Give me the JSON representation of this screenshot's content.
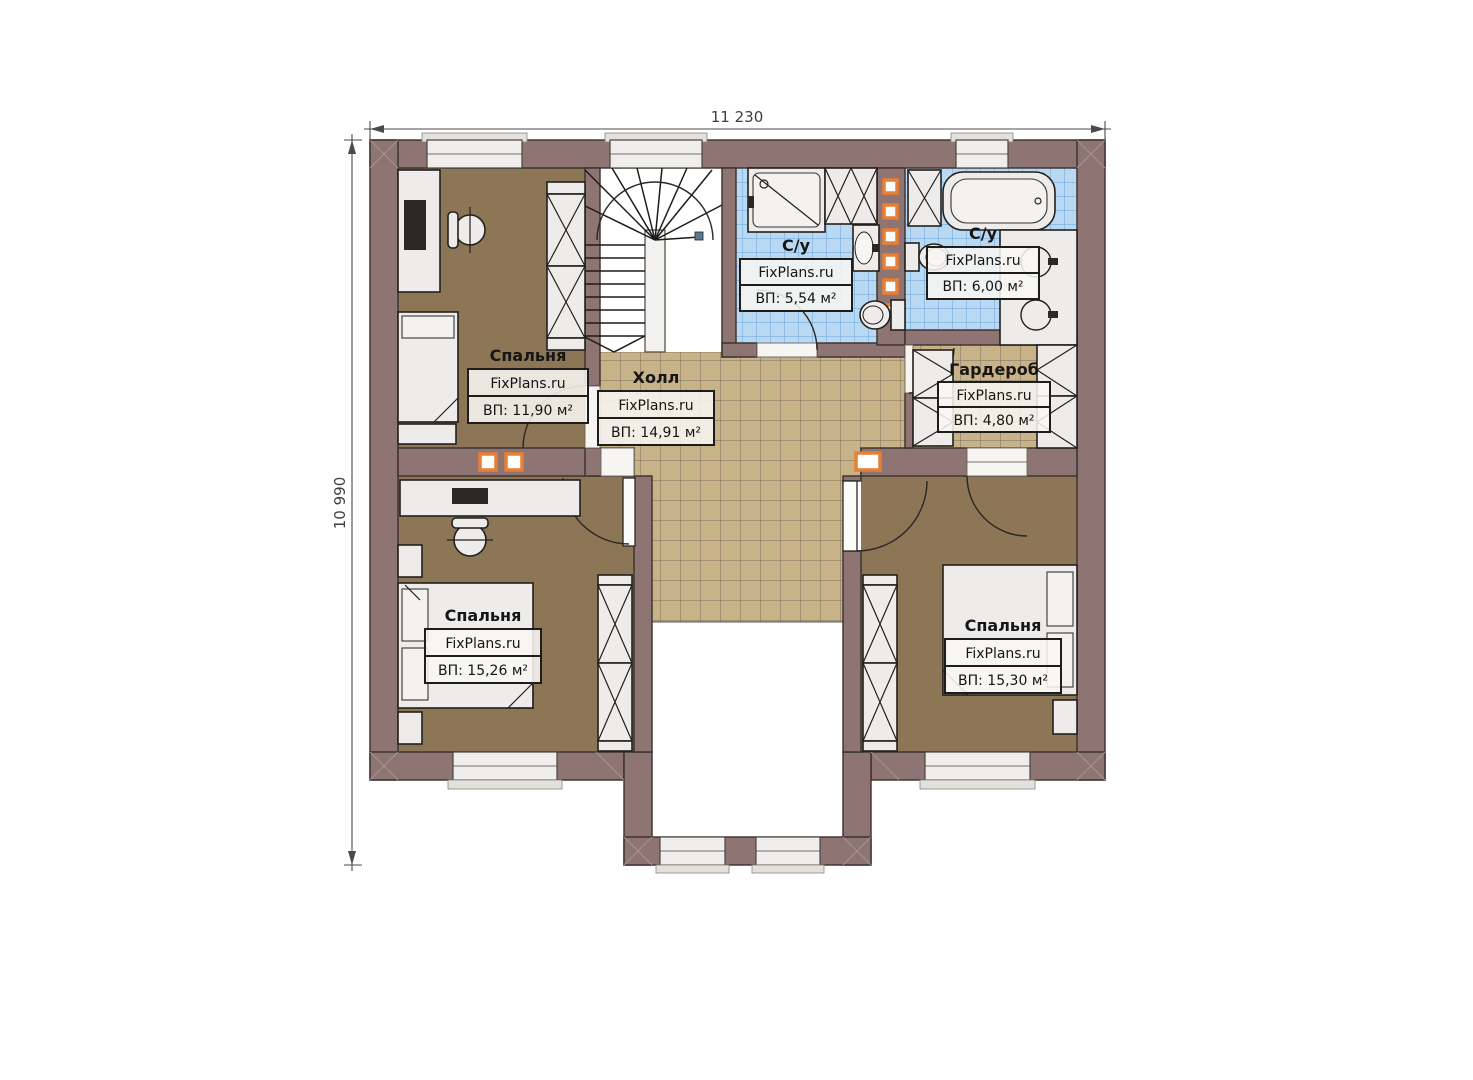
{
  "plan": {
    "dimensions": {
      "width_label": "11 230",
      "height_label": "10 990"
    },
    "rooms": [
      {
        "id": "bedroom-top-left",
        "name": "Спальня",
        "brand": "FixPlans.ru",
        "area": "ВП: 11,90 м²"
      },
      {
        "id": "hall",
        "name": "Холл",
        "brand": "FixPlans.ru",
        "area": "ВП: 14,91 м²"
      },
      {
        "id": "bathroom-left",
        "name": "С/у",
        "brand": "FixPlans.ru",
        "area": "ВП: 5,54 м²"
      },
      {
        "id": "bathroom-right",
        "name": "С/у",
        "brand": "FixPlans.ru",
        "area": "ВП: 6,00 м²"
      },
      {
        "id": "wardrobe",
        "name": "Гардероб",
        "brand": "FixPlans.ru",
        "area": "ВП: 4,80 м²"
      },
      {
        "id": "bedroom-bottom-left",
        "name": "Спальня",
        "brand": "FixPlans.ru",
        "area": "ВП: 15,26 м²"
      },
      {
        "id": "bedroom-bottom-right",
        "name": "Спальня",
        "brand": "FixPlans.ru",
        "area": "ВП: 15,30 м²"
      }
    ],
    "colors": {
      "wall": "#8e7472",
      "bedroom_floor": "#8d7656",
      "hall_tile": "#c8b288",
      "hall_tile_grid": "#7d6f5e",
      "bath_tile": "#b9d9f3",
      "bath_tile_grid": "#66a3d8",
      "furniture": "#edecea",
      "vent": "#e87f35",
      "outline": "#38302c"
    }
  }
}
